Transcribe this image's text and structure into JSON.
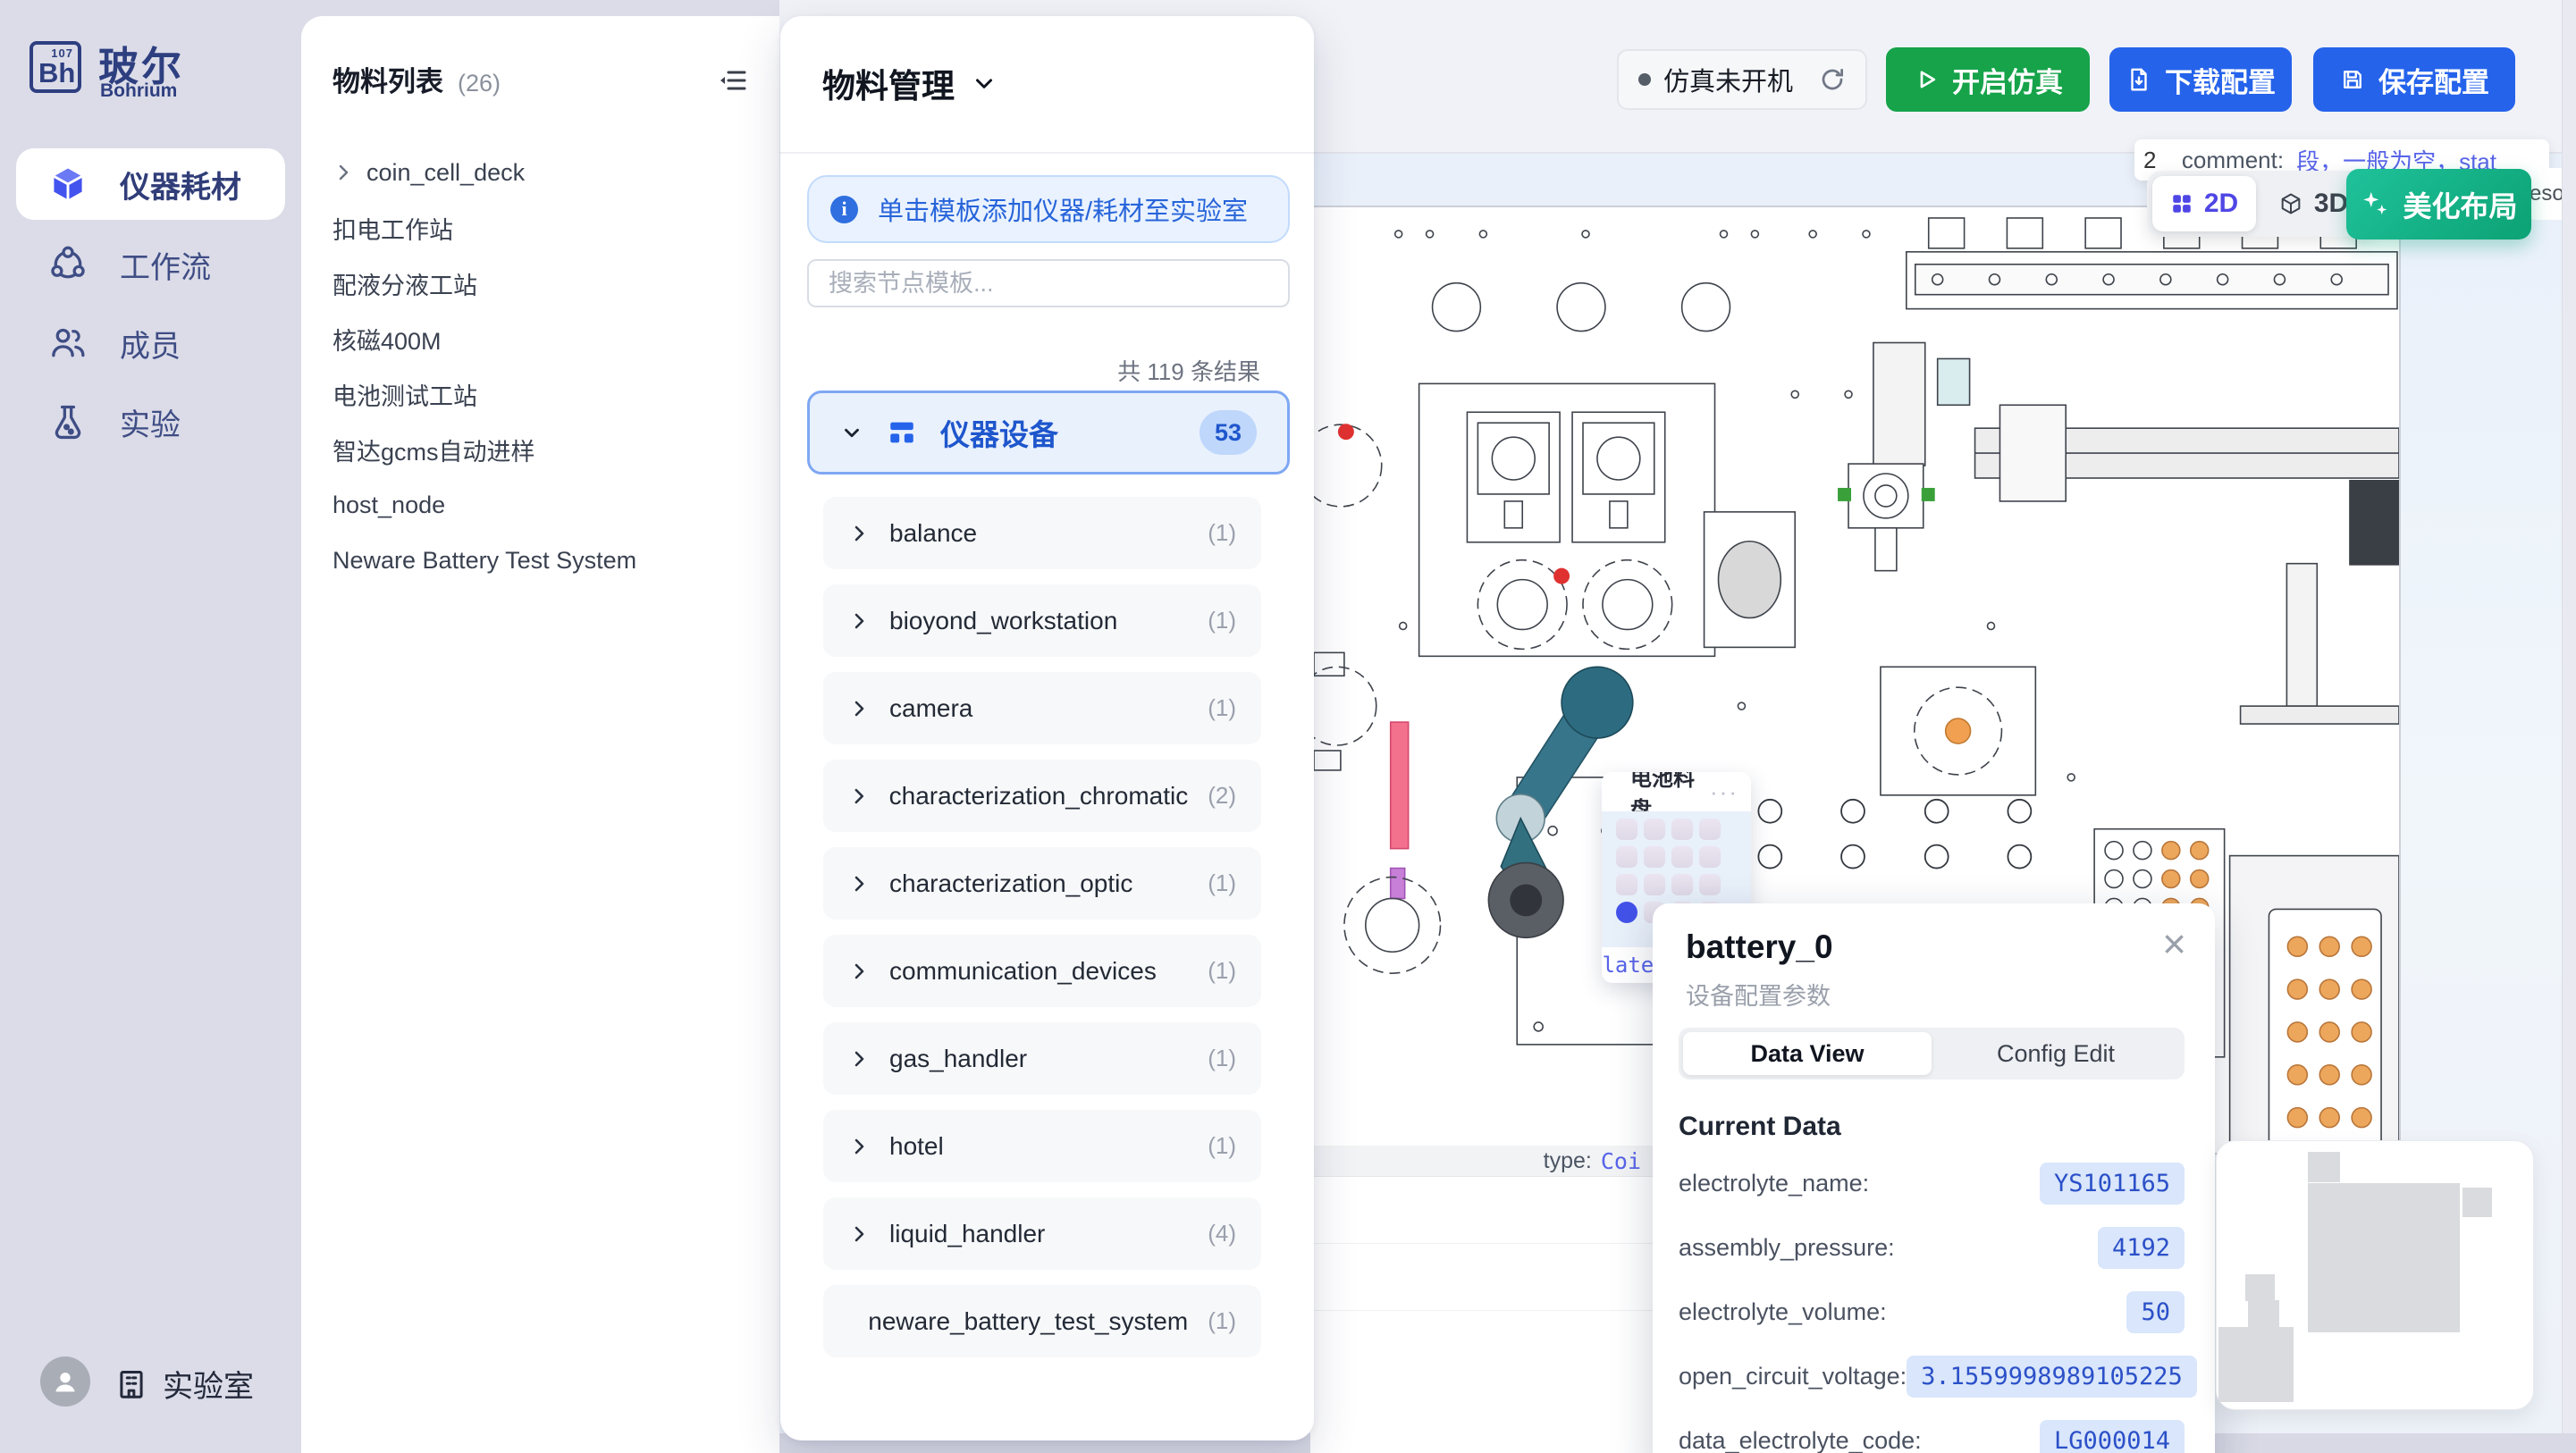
{
  "sidebar": {
    "logo": {
      "bh": "Bh",
      "num": "107",
      "cn": "玻尔",
      "en": "Bohrium"
    },
    "items": [
      {
        "label": "仪器耗材",
        "active": true
      },
      {
        "label": "工作流"
      },
      {
        "label": "成员"
      },
      {
        "label": "实验"
      }
    ],
    "footer_label": "实验室"
  },
  "materials_panel": {
    "title": "物料列表",
    "count": "(26)",
    "tree": [
      {
        "label": "coin_cell_deck",
        "expandable": true
      },
      {
        "label": "扣电工作站"
      },
      {
        "label": "配液分液工站"
      },
      {
        "label": "核磁400M"
      },
      {
        "label": "电池测试工站"
      },
      {
        "label": "智达gcms自动进样"
      },
      {
        "label": "host_node"
      },
      {
        "label": "Neware Battery Test System"
      }
    ]
  },
  "template_panel": {
    "title": "物料管理",
    "banner": "单击模板添加仪器/耗材至实验室",
    "search_placeholder": "搜索节点模板...",
    "result_count": "共 119 条结果",
    "category": {
      "label": "仪器设备",
      "count": "53"
    },
    "items": [
      {
        "label": "balance",
        "count": "(1)"
      },
      {
        "label": "bioyond_workstation",
        "count": "(1)"
      },
      {
        "label": "camera",
        "count": "(1)"
      },
      {
        "label": "characterization_chromatic",
        "count": "(2)"
      },
      {
        "label": "characterization_optic",
        "count": "(1)"
      },
      {
        "label": "communication_devices",
        "count": "(1)"
      },
      {
        "label": "gas_handler",
        "count": "(1)"
      },
      {
        "label": "hotel",
        "count": "(1)"
      },
      {
        "label": "liquid_handler",
        "count": "(4)"
      },
      {
        "label": "neware_battery_test_system",
        "count": "(1)"
      }
    ]
  },
  "topbar": {
    "status": "仿真未开机",
    "start": "开启仿真",
    "download": "下载配置",
    "save": "保存配置"
  },
  "canvas": {
    "toggle_2d": "2D",
    "toggle_3d": "3D",
    "beautify": "美化布局",
    "tooltip": {
      "prefix": "2",
      "key": "_comment:",
      "value": "段，一般为空，stat"
    },
    "edge_text": "esou",
    "tray_title": "电池料盘",
    "tray_menu": "···",
    "type_key": "type:",
    "type_value": "Coi",
    "plate_fragment": "Plate"
  },
  "popup": {
    "title": "battery_0",
    "subtitle": "设备配置参数",
    "tab_data": "Data View",
    "tab_config": "Config Edit",
    "section": "Current Data",
    "close": "×",
    "rows": [
      {
        "label": "electrolyte_name:",
        "value": "YS101165"
      },
      {
        "label": "assembly_pressure:",
        "value": "4192"
      },
      {
        "label": "electrolyte_volume:",
        "value": "50"
      },
      {
        "label": "open_circuit_voltage:",
        "value": "3.1559998989105225"
      },
      {
        "label": "data_electrolyte_code:",
        "value": "LG000014"
      }
    ]
  },
  "colors": {
    "accent_blue": "#2563eb",
    "green": "#16a34a",
    "teal_gradient": "#1fc29b",
    "indigo": "#4f46e5",
    "value_blue": "#2b50c8"
  }
}
